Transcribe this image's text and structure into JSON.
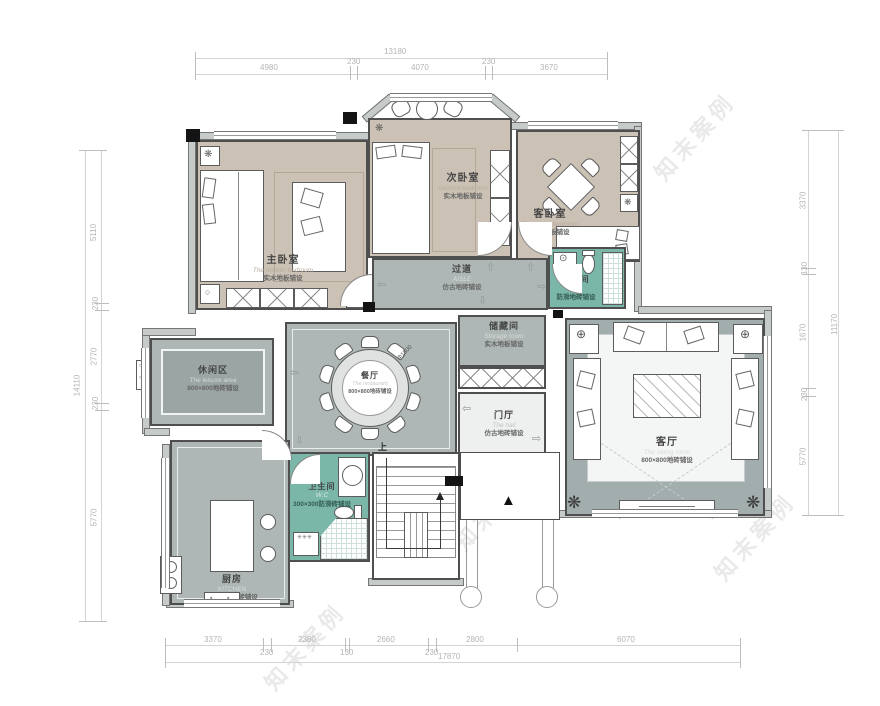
{
  "dims": {
    "top": {
      "total": "13180",
      "segs": [
        "4980",
        "230",
        "4070",
        "230",
        "3670"
      ]
    },
    "left": {
      "total": "14110",
      "segs": [
        "5110",
        "230",
        "2770",
        "230",
        "5770"
      ]
    },
    "right": {
      "total": "11170",
      "segs": [
        "3370",
        "130",
        "1670",
        "230",
        "5770"
      ]
    },
    "bottom": {
      "total": "17870",
      "segs": [
        "3370",
        "230",
        "2380",
        "130",
        "2660",
        "230",
        "2800",
        "6070"
      ]
    }
  },
  "rooms": [
    {
      "name": "主卧室",
      "en": "The master bedroom",
      "floor": "实木地板铺设"
    },
    {
      "name": "次卧室",
      "en": "Second bedroom",
      "floor": "实木地板铺设"
    },
    {
      "name": "客卧室",
      "en": "The guest bedroom",
      "floor": "实木地板铺设"
    },
    {
      "name": "卫生间",
      "en": "W.C",
      "floor": "防滑地砖铺设"
    },
    {
      "name": "过道",
      "en": "AISLE",
      "floor": "仿古地砖铺设"
    },
    {
      "name": "储藏间",
      "en": "Storage room",
      "floor": "实木地板铺设"
    },
    {
      "name": "餐厅",
      "en": "The restaurant",
      "floor": "800×800地砖铺设"
    },
    {
      "name": "休闲区",
      "en": "The leisure area",
      "floor": "800×800地砖铺设"
    },
    {
      "name": "门厅",
      "en": "The hall",
      "floor": "仿古地砖铺设"
    },
    {
      "name": "客厅",
      "en": "The sitting room",
      "floor": "800×800地砖铺设"
    },
    {
      "name": "厨房",
      "en": "KITCHEN",
      "floor": "300×300地砖铺设"
    },
    {
      "name": "卫生间",
      "en": "W.C",
      "floor": "300×300防滑砖铺设"
    }
  ],
  "icons": {
    "arrow_up": "⇧",
    "arrow_down": "⇩",
    "arrow_left": "⇦",
    "arrow_right": "⇨",
    "plant": "❋",
    "flower": "✿",
    "entry_triangle": "▲",
    "circle_target": "⊕"
  },
  "annotations": {
    "stair_up": "上",
    "table_diameter": "Φ1500",
    "watermark": "知末案例"
  },
  "colors": {
    "wood_floor": "#cbc1b4",
    "gray_tile": "#aeb7b5",
    "teal_tile": "#7ab7a8",
    "wall": "#4f4f4f"
  }
}
